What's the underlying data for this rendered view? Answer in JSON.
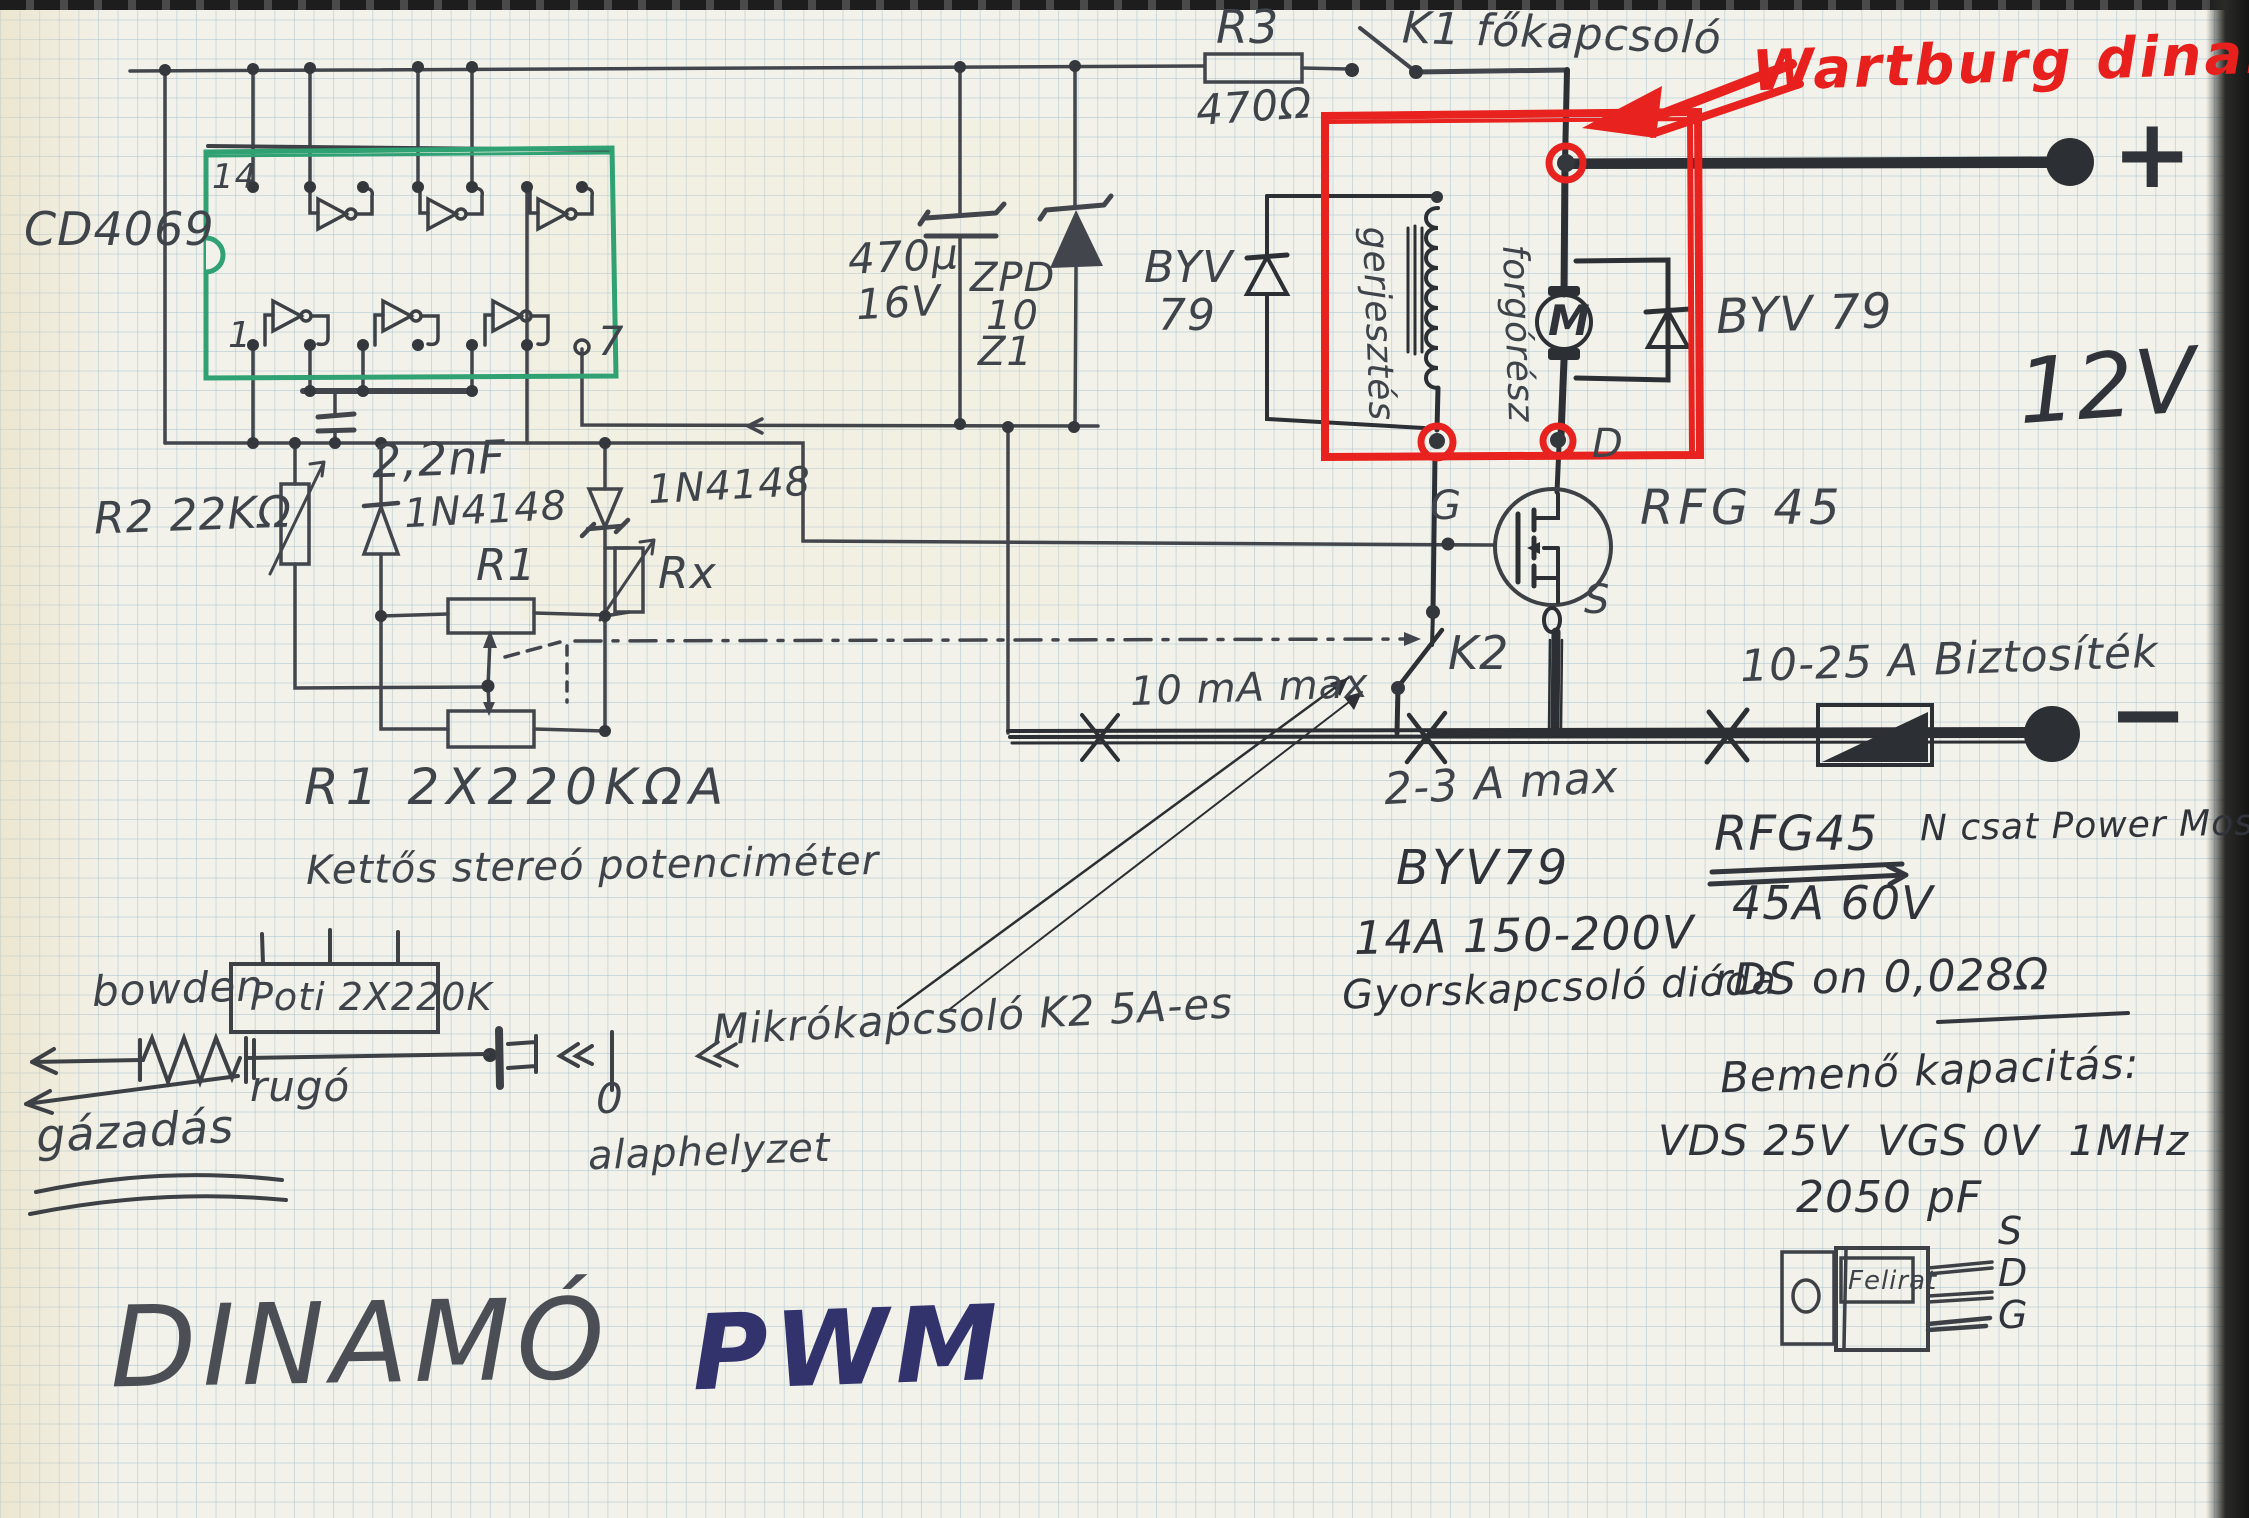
{
  "page": {
    "title_main": "DINAMÓ",
    "title_accent": "PWM"
  },
  "power": {
    "r3_name": "R3",
    "r3_value": "470Ω",
    "k1": "K1 főkapcsoló",
    "plus": "+",
    "minus": "−",
    "battery": "12V",
    "fuse": "10-25 A Biztosíték"
  },
  "dynamo": {
    "title": "Wartburg dinamó",
    "field": "gerjesztés",
    "rotor": "forgórész",
    "motor": "M",
    "terminal_d": "D"
  },
  "ic": {
    "name": "CD4069",
    "pin14": "14",
    "pin1": "1",
    "pin7": "7"
  },
  "filter": {
    "cap_value": "470µ",
    "cap_voltage": "16V",
    "zener_line1": "ZPD",
    "zener_line2": "10",
    "zener_line3": "Z1"
  },
  "freewheel": {
    "left_line1": "BYV",
    "left_line2": "79",
    "right": "BYV 79"
  },
  "mosfet": {
    "name": "RFG 45",
    "g": "G",
    "s": "S"
  },
  "osc": {
    "cap": "2,2nF",
    "r2": "R2 22KΩ",
    "d1": "1N4148",
    "d2": "1N4148",
    "r1": "R1",
    "rx": "Rx"
  },
  "pot": {
    "designator": "R1 2X220KΩA",
    "description": "Kettős stereó potenciméter",
    "box": "Poti 2X220K",
    "bowden": "bowden",
    "spring": "rugó",
    "throttle": "gázadás",
    "zero": "0",
    "home": "alaphelyzet",
    "micro": "Mikrókapcsoló K2 5A-es"
  },
  "switching": {
    "gate_current": "10 mA max",
    "k2": "K2",
    "k2_rating": "2-3 A max"
  },
  "specs": {
    "byv79_name": "BYV79",
    "byv79_rating": "14A 150-200V",
    "byv79_desc": "Gyorskapcsoló dióda",
    "rfg45_name": "RFG45",
    "rfg45_type": "N csat Power Mosfet",
    "rfg45_rating": "45A 60V",
    "rfg45_rds": "rDS on 0,028Ω",
    "cap_title": "Bemenő kapacitás:",
    "cap_cond": "VDS 25V  VGS 0V  1MHz",
    "cap_value": "2050 pF",
    "pkg_label": "Felirat",
    "pin_s": "S",
    "pin_d": "D",
    "pin_g": "G"
  }
}
